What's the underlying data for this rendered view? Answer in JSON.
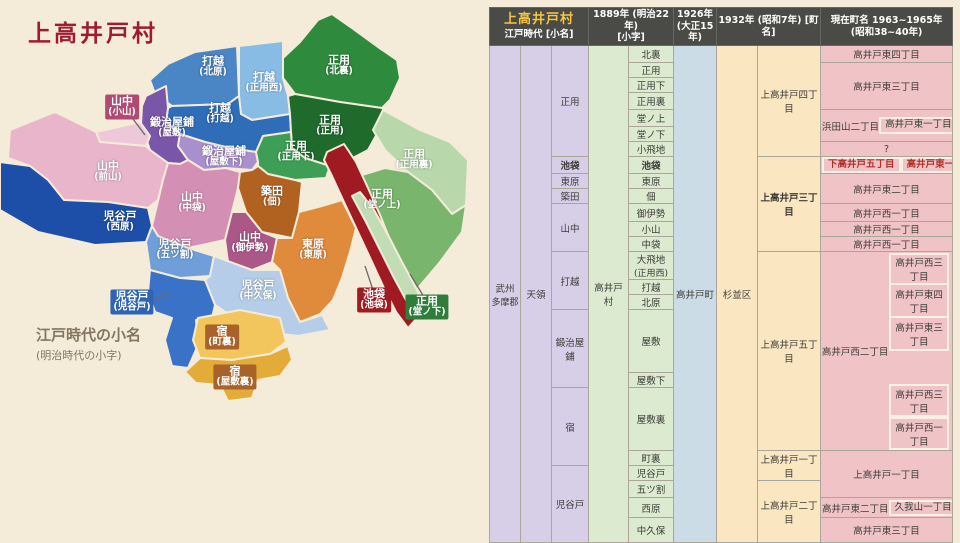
{
  "map": {
    "title": "上高井戸村",
    "caption": {
      "line1": "江戸時代の小名",
      "line2": "(明治時代の小字)"
    },
    "regions": [
      {
        "name": "打越",
        "sub": "(北原)",
        "color": "#4a85c5"
      },
      {
        "name": "打越",
        "sub": "(正用西)",
        "color": "#88bce4"
      },
      {
        "name": "正用",
        "sub": "(北裏)",
        "color": "#2e8b3e"
      },
      {
        "name": "打越",
        "sub": "(打越)",
        "color": "#2f6db8"
      },
      {
        "name": "鍛治屋鋪",
        "sub": "(屋敷)",
        "color": "#7a56a8"
      },
      {
        "name": "正用",
        "sub": "(正用)",
        "color": "#1e6b2c"
      },
      {
        "name": "山中",
        "sub": "(小山)",
        "color": "#ecc8d8",
        "chip": "#b04a72"
      },
      {
        "name": "鍛治屋鋪",
        "sub": "(屋敷下)",
        "color": "#a98fcc"
      },
      {
        "name": "正用",
        "sub": "(正用下)",
        "color": "#3f9e55"
      },
      {
        "name": "正用",
        "sub": "(正用裏)",
        "color": "#b8d8ac"
      },
      {
        "name": "山中",
        "sub": "(前山)",
        "color": "#e8b5cb"
      },
      {
        "name": "山中",
        "sub": "(中袋)",
        "color": "#d490b4"
      },
      {
        "name": "築田",
        "sub": "(佃)",
        "color": "#b26220"
      },
      {
        "name": "正用",
        "sub": "(堂ノ上)",
        "color": "#7ab56e"
      },
      {
        "name": "児谷戸",
        "sub": "(西原)",
        "color": "#1d4fa8"
      },
      {
        "name": "山中",
        "sub": "(御伊勢)",
        "color": "#ab5788"
      },
      {
        "name": "児谷戸",
        "sub": "(五ツ割)",
        "color": "#6f9ed8"
      },
      {
        "name": "東原",
        "sub": "(東原)",
        "color": "#e08a3c"
      },
      {
        "name": "児谷戸",
        "sub": "(中久保)",
        "color": "#b5cde8"
      },
      {
        "name": "児谷戸",
        "sub": "(児谷戸)",
        "color": "#3a72c8",
        "chip": "#2f64b5"
      },
      {
        "name": "池袋",
        "sub": "(池袋)",
        "color": "#a01a22",
        "chip": "#a01a22"
      },
      {
        "name": "正用",
        "sub": "(堂ノ下)",
        "color": "#c2ddb5",
        "chip": "#2e7d3a"
      },
      {
        "name": "宿",
        "sub": "(町裏)",
        "color": "#f2c65c",
        "chip": "#a8622a"
      },
      {
        "name": "宿",
        "sub": "(屋敷裏)",
        "color": "#e3ab38",
        "chip": "#a8622a"
      }
    ]
  },
  "table": {
    "header": {
      "village_title": "上高井戸村",
      "edo_sub": "江戸時代 [小名]",
      "y1889_line1": "1889年 (明治22年)",
      "y1889_line2": "[小字]",
      "y1926_line1": "1926年",
      "y1926_line2": "(大正15年)",
      "y1932": "1932年 (昭和7年) [町名]",
      "current_line1": "現在町名 1963~1965年",
      "current_line2": "(昭和38~40年)"
    },
    "province_line1": "武州",
    "province_line2": "多摩郡",
    "tenryo": "天領",
    "village_1889": "高井戸村",
    "town_1926": "高井戸町",
    "ward_1932": "杉並区",
    "edo_names": [
      "正用",
      "池袋",
      "東原",
      "築田",
      "山中",
      "打越",
      "鍛治屋鋪",
      "宿",
      "児谷戸"
    ],
    "koaza": [
      "北裏",
      "正用",
      "正用下",
      "正用裏",
      "堂ノ上",
      "堂ノ下",
      "小飛地",
      "池袋",
      "東原",
      "佃",
      "御伊勢",
      "小山",
      "中袋",
      "大飛地",
      "打越",
      "北原",
      "屋敷",
      "屋敷下",
      "屋敷裏",
      "町裏",
      "児谷戸",
      "五ツ割",
      "西原",
      "中久保"
    ],
    "koaza_13_sub": "(正用西)",
    "cho_1932": [
      "上高井戸四丁目",
      "上高井戸三丁目",
      "上高井戸五丁目",
      "上高井戸一丁目",
      "上高井戸二丁目"
    ],
    "current": {
      "r1": "高井戸東四丁目",
      "r2": "高井戸東三丁目",
      "r5_left": "浜田山二丁目",
      "r5_box": "高井戸東一丁目",
      "r7": "?",
      "r8_left": "下高井戸五丁目",
      "r8_right": "高井戸東一丁目",
      "r9": "高井戸東二丁目",
      "r11": "高井戸西一丁目",
      "r12": "高井戸西一丁目",
      "r13": "高井戸西一丁目",
      "r14_main": "高井戸西二丁目",
      "r14_box1": "高井戸西三丁目",
      "r14_box2": "高井戸東四丁目",
      "r14_box3": "高井戸東三丁目",
      "r14_box4": "高井戸西三丁目",
      "r14_box5": "高井戸西一丁目",
      "r20": "上高井戸一丁目",
      "r23_left": "高井戸東二丁目",
      "r23_box": "久我山一丁目",
      "r24": "高井戸東三丁目"
    }
  }
}
